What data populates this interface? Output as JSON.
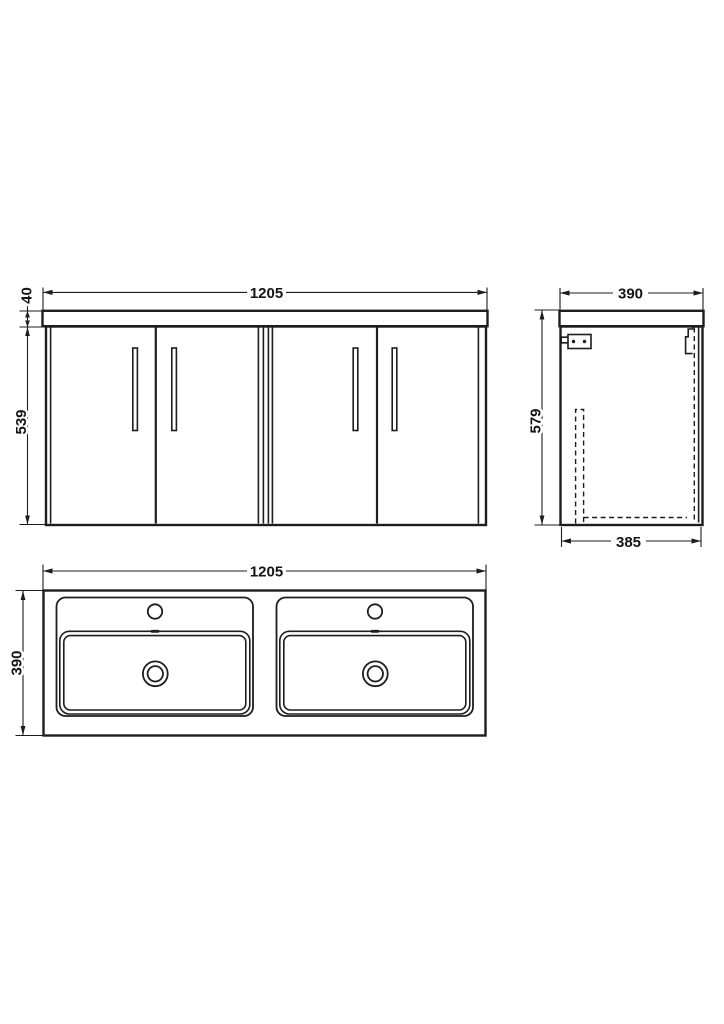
{
  "drawing": {
    "type": "wall-hung vanity unit with double basin - dimensioned technical drawing",
    "background_color": "#ffffff",
    "line_color": "#1d1d1d"
  },
  "views": {
    "front_elevation": {
      "dimensions": {
        "overall_width": "1205",
        "worktop_thickness": "40",
        "cabinet_height": "539"
      }
    },
    "side_elevation": {
      "dimensions": {
        "overall_depth": "390",
        "overall_height": "579",
        "cabinet_depth": "385"
      }
    },
    "plan_view": {
      "dimensions": {
        "overall_width": "1205",
        "overall_depth": "390"
      }
    }
  }
}
